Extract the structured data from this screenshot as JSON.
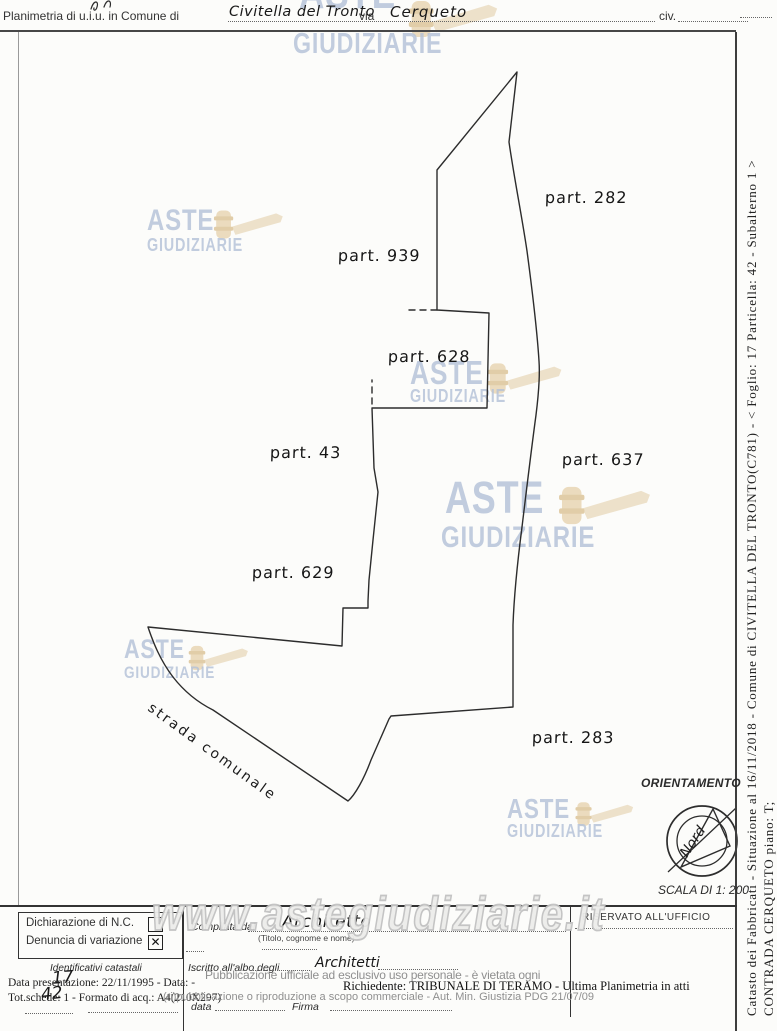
{
  "header": {
    "title_label": "Planimetria di u.i.u. in Comune di",
    "comune_value": "Civitella del Tronto",
    "via_label": "via",
    "via_value": "Cerqueto",
    "civ_label": "civ."
  },
  "plan": {
    "parcels": {
      "p282": "part. 282",
      "p939": "part. 939",
      "p628": "part. 628",
      "p43": "part. 43",
      "p637": "part. 637",
      "p629": "part. 629",
      "p283": "part. 283"
    },
    "road_label": "strada comunale",
    "orientation_label": "ORIENTAMENTO",
    "compass_north_label": "Nord",
    "scale_label": "SCALA DI 1: 200"
  },
  "watermark": {
    "word1": "ASTE",
    "word2": "GIUDIZIARIE",
    "site_url": "www.astegiudiziarie.it",
    "blue": "#b3c1d8",
    "gavel_tan": "#e7d4b0"
  },
  "side_text": {
    "line1": "Catasto dei Fabbricati - Situazione al 16/11/2018 - Comune di CIVITELLA DEL TRONTO(C781) - < Foglio: 17 Particella: 42 - Subalterno 1 >",
    "line2": "CONTRADA CERQUETO piano: T;"
  },
  "form": {
    "dichiarazione_label": "Dichiarazione di N.C.",
    "denuncia_label": "Denuncia di variazione",
    "checked_mark": "✕",
    "identificativi_label": "Identificativi catastali",
    "foglio_handwritten": "17",
    "particella_handwritten": "42",
    "data_presentazione_line": "Data presentazione: 22/11/1995 - Data: -",
    "tot_schede_line": "Tot.schede: 1 - Formato di acq.: A4(210X297)",
    "compilata_label": "Compilata dal",
    "compilata_value": "Architetto",
    "compilata_hint": "(Titolo, cognome e nome)",
    "iscritto_label": "Iscritto all'albo degli",
    "iscritto_value": "Architetti",
    "data_label": "data",
    "firma_label": "Firma",
    "riservato_label": "RISERVATO ALL'UFFICIO"
  },
  "legal": {
    "pub_line1": "Pubblicazione ufficiale ad esclusivo uso personale - è vietata ogni",
    "pub_line2": "(ri)pubblicazione o riproduzione a scopo commerciale - Aut. Min. Giustizia PDG 21/07/09",
    "richiedente_line": "Richiedente: TRIBUNALE DI TERAMO - Ultima Planimetria in atti"
  }
}
